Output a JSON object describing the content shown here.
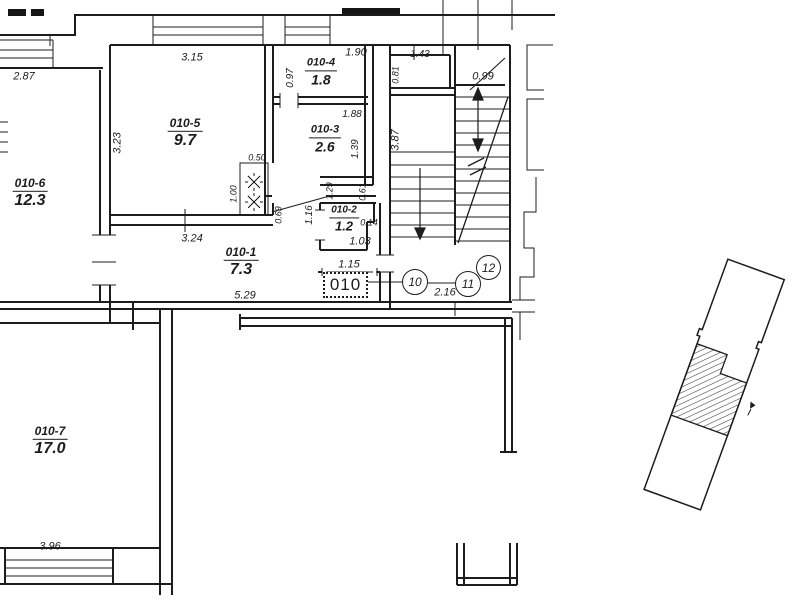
{
  "colors": {
    "ink": "#1c1c1c",
    "paper": "#ffffff",
    "hatch": "#3a3a3a"
  },
  "rooms": {
    "r1": {
      "id": "010-1",
      "area": "7.3"
    },
    "r2": {
      "id": "010-2",
      "area": "1.2"
    },
    "r3": {
      "id": "010-3",
      "area": "2.6"
    },
    "r4": {
      "id": "010-4",
      "area": "1.8"
    },
    "r5": {
      "id": "010-5",
      "area": "9.7"
    },
    "r6": {
      "id": "010-6",
      "area": "12.3"
    },
    "r7": {
      "id": "010-7",
      "area": "17.0"
    }
  },
  "dims": {
    "w287": "2.87",
    "w315": "3.15",
    "w323": "3.23",
    "w324": "3.24",
    "w529": "5.29",
    "w050": "0.50",
    "w100": "1.00",
    "w069": "0.69",
    "w190": "1.90",
    "w097": "0.97",
    "w188": "1.88",
    "w139": "1.39",
    "w129": "1.29",
    "w061": "0.61",
    "w116": "1.16",
    "w014": "0.14",
    "w103": "1.03",
    "w115": "1.15",
    "w216": "2.16",
    "w143": "1.43",
    "w081": "0.81",
    "w387": "3.87",
    "w099": "0.99",
    "w396": "3.96"
  },
  "entrance": {
    "unit": "010"
  },
  "circles": {
    "c10": "10",
    "c11": "11",
    "c12": "12"
  }
}
